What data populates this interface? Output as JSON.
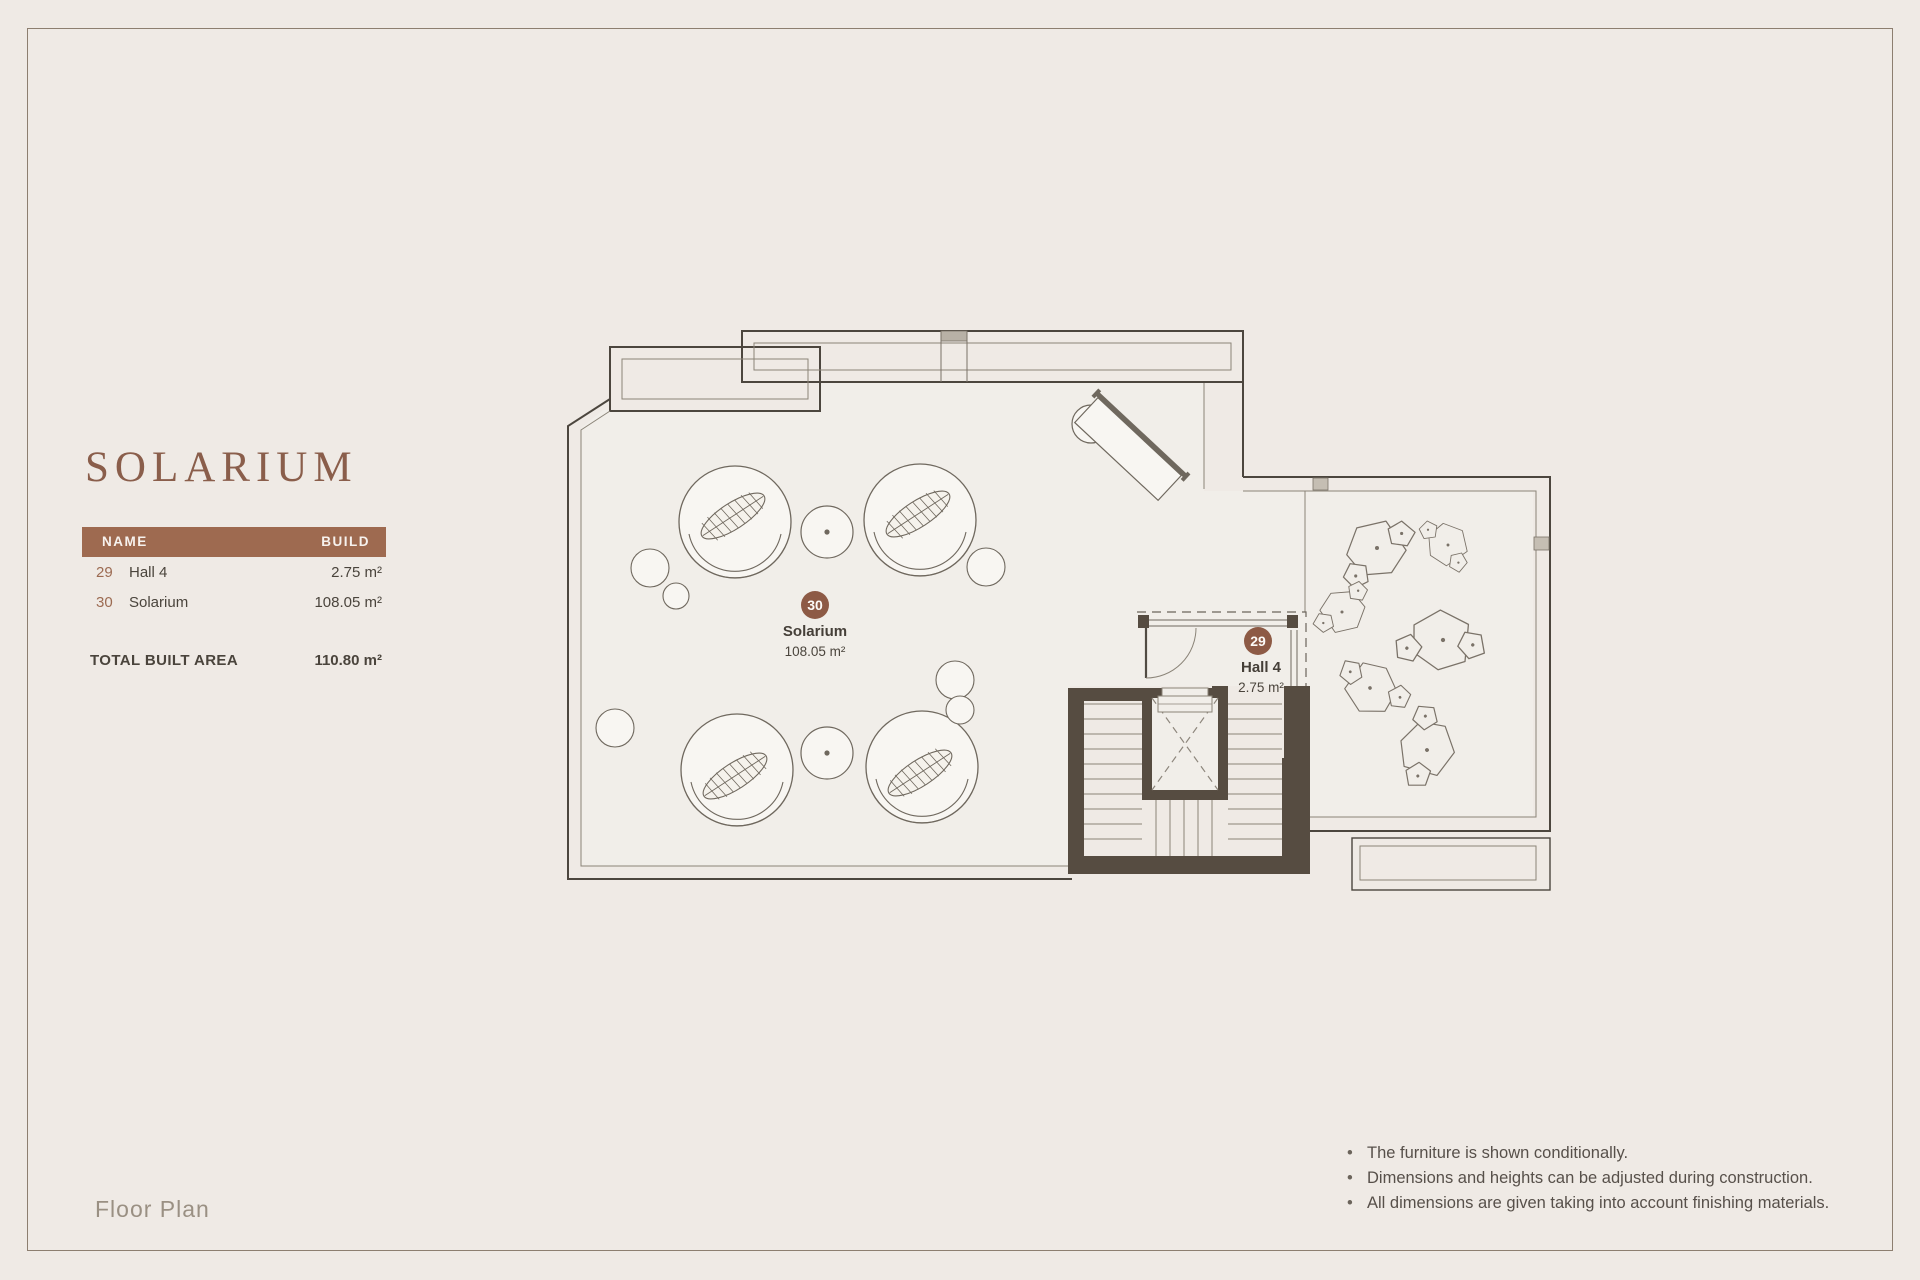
{
  "page": {
    "title": "SOLARIUM",
    "footer_label": "Floor Plan"
  },
  "colors": {
    "accent_header": "#9e6a50",
    "title_brown": "#8a5e4b",
    "badge_brown": "#8d5a45",
    "wall_dark": "#564c41",
    "background": "#efeae5"
  },
  "area_table": {
    "headers": {
      "name": "NAME",
      "build": "BUILD"
    },
    "rows": [
      {
        "num": "29",
        "name": "Hall 4",
        "area": "2.75 m²"
      },
      {
        "num": "30",
        "name": "Solarium",
        "area": "108.05 m²"
      }
    ],
    "total": {
      "label": "TOTAL BUILT AREA",
      "value": "110.80 m²"
    }
  },
  "plan": {
    "rooms": [
      {
        "num": "30",
        "name": "Solarium",
        "area": "108.05 m²"
      },
      {
        "num": "29",
        "name": "Hall 4",
        "area": "2.75 m²"
      }
    ]
  },
  "notes": [
    "The furniture is shown conditionally.",
    "Dimensions and heights can be adjusted during construction.",
    "All dimensions are given taking into account finishing materials."
  ]
}
